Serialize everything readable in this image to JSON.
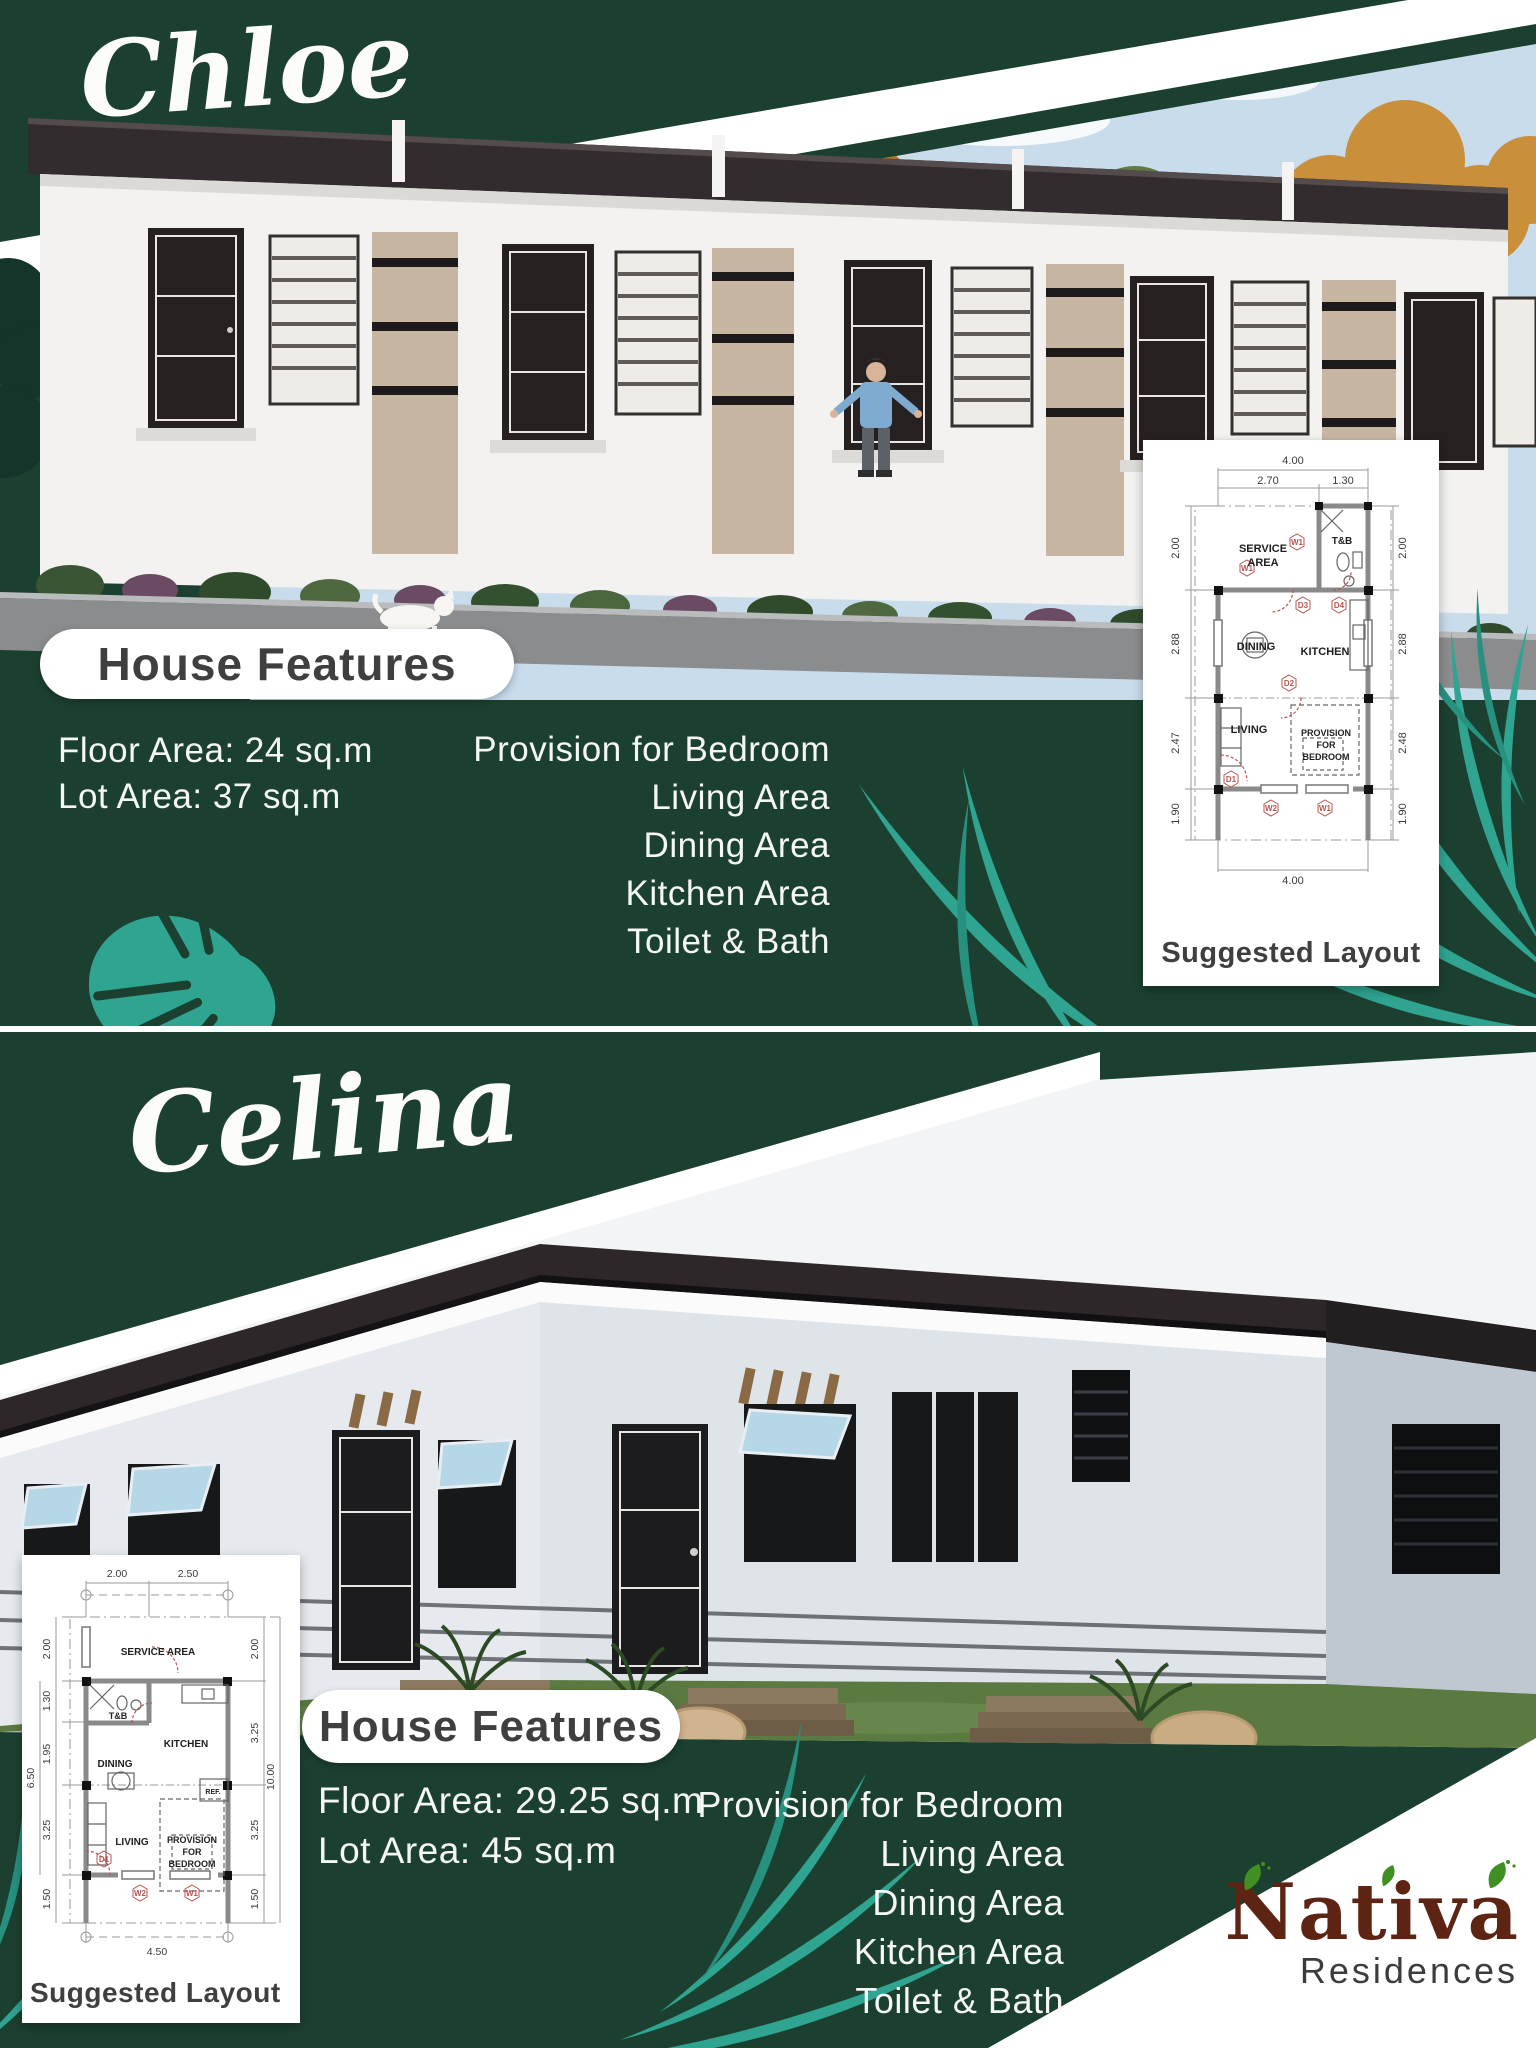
{
  "poster": {
    "colors": {
      "background_green": "#1c4030",
      "leaf_teal": "#2fa491",
      "heading_text": "#3f3f3f",
      "logo_brown": "#5e2413",
      "marker_red": "#b85450"
    },
    "chloe": {
      "title": "Chloe",
      "features_heading": "House Features",
      "floor_area_label": "Floor Area: 24 sq.m",
      "lot_area_label": "Lot Area: 37 sq.m",
      "provisions": [
        "Provision for Bedroom",
        "Living Area",
        "Dining Area",
        "Kitchen Area",
        "Toilet & Bath"
      ],
      "layout_caption": "Suggested Layout",
      "plan": {
        "dims_top": [
          "4.00",
          "2.70",
          "1.30"
        ],
        "dims_left": [
          "2.00",
          "2.88",
          "2.47",
          "1.90"
        ],
        "dims_right": [
          "2.00",
          "2.88",
          "2.48",
          "1.90"
        ],
        "dims_bottom": [
          "4.00"
        ],
        "rooms": {
          "service_line1": "SERVICE",
          "service_line2": "AREA",
          "toilet_bath": "T&B",
          "dining": "DINING",
          "kitchen": "KITCHEN",
          "living": "LIVING",
          "bedroom_line1": "PROVISION",
          "bedroom_line2": "FOR",
          "bedroom_line3": "BEDROOM"
        },
        "markers": [
          "W1",
          "W1",
          "D3",
          "D4",
          "D2",
          "D1",
          "W2",
          "W1"
        ]
      }
    },
    "celina": {
      "title": "Celina",
      "features_heading": "House Features",
      "floor_area_label": "Floor Area: 29.25 sq.m",
      "lot_area_label": "Lot Area: 45 sq.m",
      "provisions": [
        "Provision for Bedroom",
        "Living Area",
        "Dining Area",
        "Kitchen Area",
        "Toilet & Bath"
      ],
      "layout_caption": "Suggested Layout",
      "plan": {
        "dims_top": [
          "2.00",
          "2.50"
        ],
        "dims_left": [
          "2.00",
          "1.30",
          "1.95",
          "6.50",
          "3.25",
          "1.50"
        ],
        "dims_right": [
          "2.00",
          "3.25",
          "10.00",
          "3.25",
          "1.50"
        ],
        "dims_bottom": [
          "4.50"
        ],
        "rooms": {
          "service": "SERVICE AREA",
          "toilet_bath": "T&B",
          "kitchen": "KITCHEN",
          "dining": "DINING",
          "refrigerator": "REF.",
          "living": "LIVING",
          "bedroom_line1": "PROVISION",
          "bedroom_line2": "FOR",
          "bedroom_line3": "BEDROOM"
        },
        "markers": [
          "D1",
          "W2",
          "W1"
        ]
      }
    },
    "logo": {
      "brand": "Nativa",
      "subtitle": "Residences"
    }
  }
}
